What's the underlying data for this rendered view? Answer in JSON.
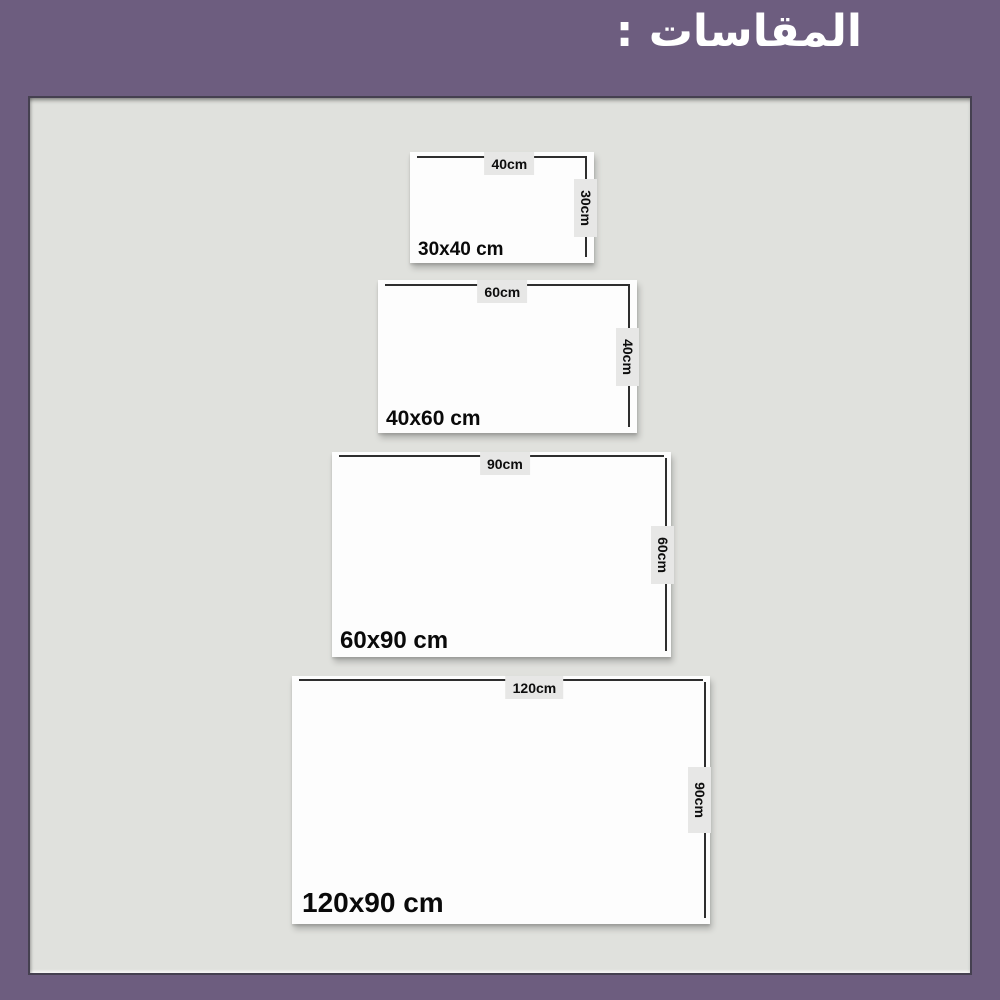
{
  "title": "المقاسات :",
  "colors": {
    "background": "#6d5d7f",
    "panel": "#e0e1dd",
    "panel_border": "#454050",
    "card": "#fdfdfd",
    "chip": "#e7e7e6",
    "dimension_line": "#2e2e2e",
    "label_text": "#0d0d0d",
    "title_text": "#ffffff"
  },
  "sizes": [
    {
      "name": "30x40 cm",
      "width_label": "40cm",
      "height_label": "30cm"
    },
    {
      "name": "40x60 cm",
      "width_label": "60cm",
      "height_label": "40cm"
    },
    {
      "name": "60x90 cm",
      "width_label": "90cm",
      "height_label": "60cm"
    },
    {
      "name": "120x90 cm",
      "width_label": "120cm",
      "height_label": "90cm"
    }
  ]
}
